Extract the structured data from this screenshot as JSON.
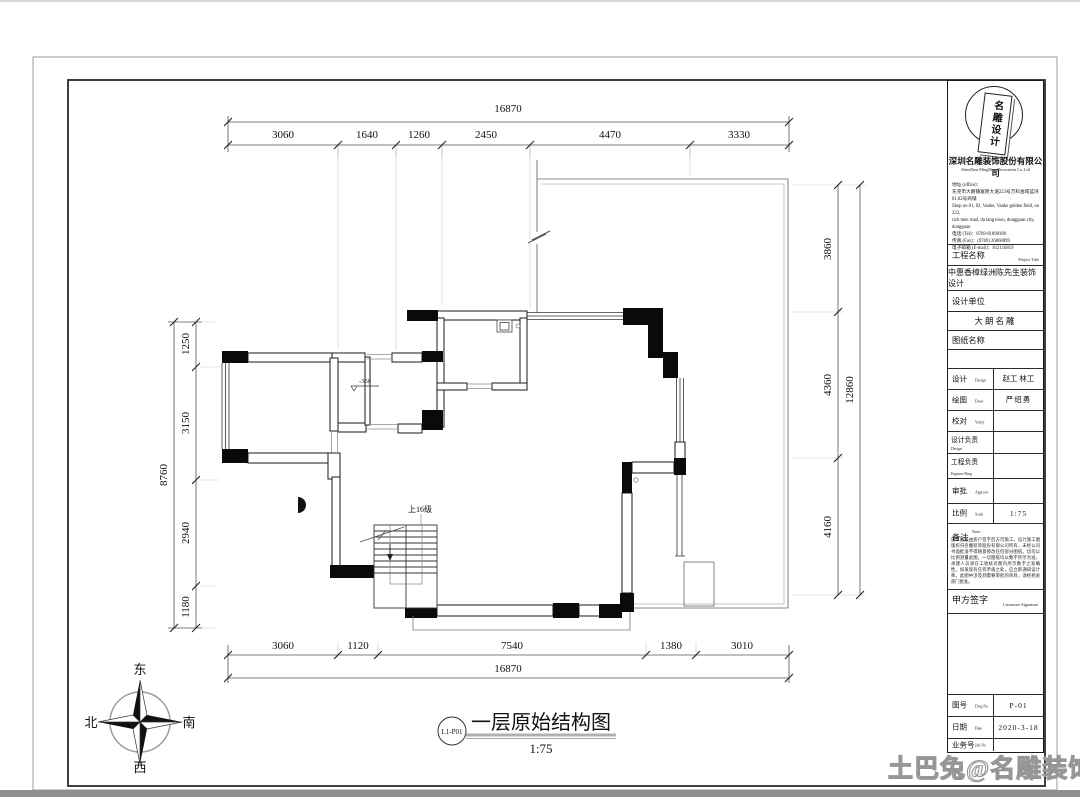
{
  "sheet": {
    "drawing_title": {
      "ref": "L1-P01",
      "title": "一层原始结构图",
      "scale": "1:75"
    },
    "watermark": "土巴兔@名雕装饰",
    "compass": {
      "east": "东",
      "south": "南",
      "west": "西",
      "north": "北"
    },
    "plan": {
      "stair_label": "上16级",
      "level_label": "-350",
      "dims_top": {
        "overall": "16870",
        "segments": [
          "3060",
          "1640",
          "1260",
          "2450",
          "4470",
          "3330"
        ]
      },
      "dims_bottom": {
        "overall": "16870",
        "segments": [
          "3060",
          "1120",
          "7540",
          "1380",
          "3010"
        ]
      },
      "dims_left": {
        "overall": "8760",
        "segments": [
          "1250",
          "3150",
          "2940",
          "1180"
        ]
      },
      "dims_right": {
        "overall": "12860",
        "segments": [
          "3860",
          "4360",
          "4160"
        ]
      }
    },
    "title_block": {
      "logo_text": "名雕设计",
      "company_cn": "深圳名雕装饰股份有限公司",
      "company_en": "ShenZhen MingDiao Decoration Co.,Ltd",
      "address_lines": [
        "地址 (office)：",
        "东莞市大朗镇富民大道222号万科金域蓝湾",
        "01.02号商铺",
        "Shop no 01, 02, Vanke, Vanke golden field, no 222,",
        "rich men road, da lang town, dongguan city, dongguan",
        "电话 (Tel)：0769-81898188",
        "传真 (Fax)：(0769) 26868899",
        "电子邮箱 (E-mail)：812116819"
      ],
      "project_label_cn": "工程名称",
      "project_label_en": "Project Title",
      "project_name": "中惠香樟绿洲陈先生装饰设计",
      "design_unit_label": "设计单位",
      "design_unit": "大朗名雕",
      "drawing_name_label": "图纸名称",
      "rows": [
        {
          "cn": "设计",
          "en": "Design",
          "value": "赵工 林工"
        },
        {
          "cn": "绘图",
          "en": "Draw",
          "value": "严绍勇"
        },
        {
          "cn": "校对",
          "en": "Verify",
          "value": ""
        },
        {
          "cn": "设计负责",
          "en": "Design",
          "value": ""
        },
        {
          "cn": "工程负责",
          "en": "Enginee Ring",
          "value": ""
        },
        {
          "cn": "审批",
          "en": "Approve",
          "value": ""
        },
        {
          "cn": "比例",
          "en": "Scale",
          "value": "1:75"
        }
      ],
      "note_label_cn": "备注",
      "note_label_en": "Note:",
      "note_text": "施工图纸由客户签字后方可施工，设计施工图版权归名雕装饰股份有限公司所有，未经公司书面批准不得随意修改任何部分图纸。切勿以比例测量此图，一切图纸均以数字所示为准，承建人员须在工地核对图内所示数字之准确性，如发现有任何矛盾之处，应立即通知设计师。此图中涉及到需要审批的项目，须经相关部门批准。",
      "signature_label_cn": "甲方签字",
      "signature_label_en": "Customer Signature",
      "footer_rows": [
        {
          "cn": "图号",
          "en": "Dwg  No",
          "value": "P-01"
        },
        {
          "cn": "日期",
          "en": "Date",
          "value": "2020-3-18"
        },
        {
          "cn": "业务号",
          "en": "Job No",
          "value": ""
        }
      ]
    }
  }
}
